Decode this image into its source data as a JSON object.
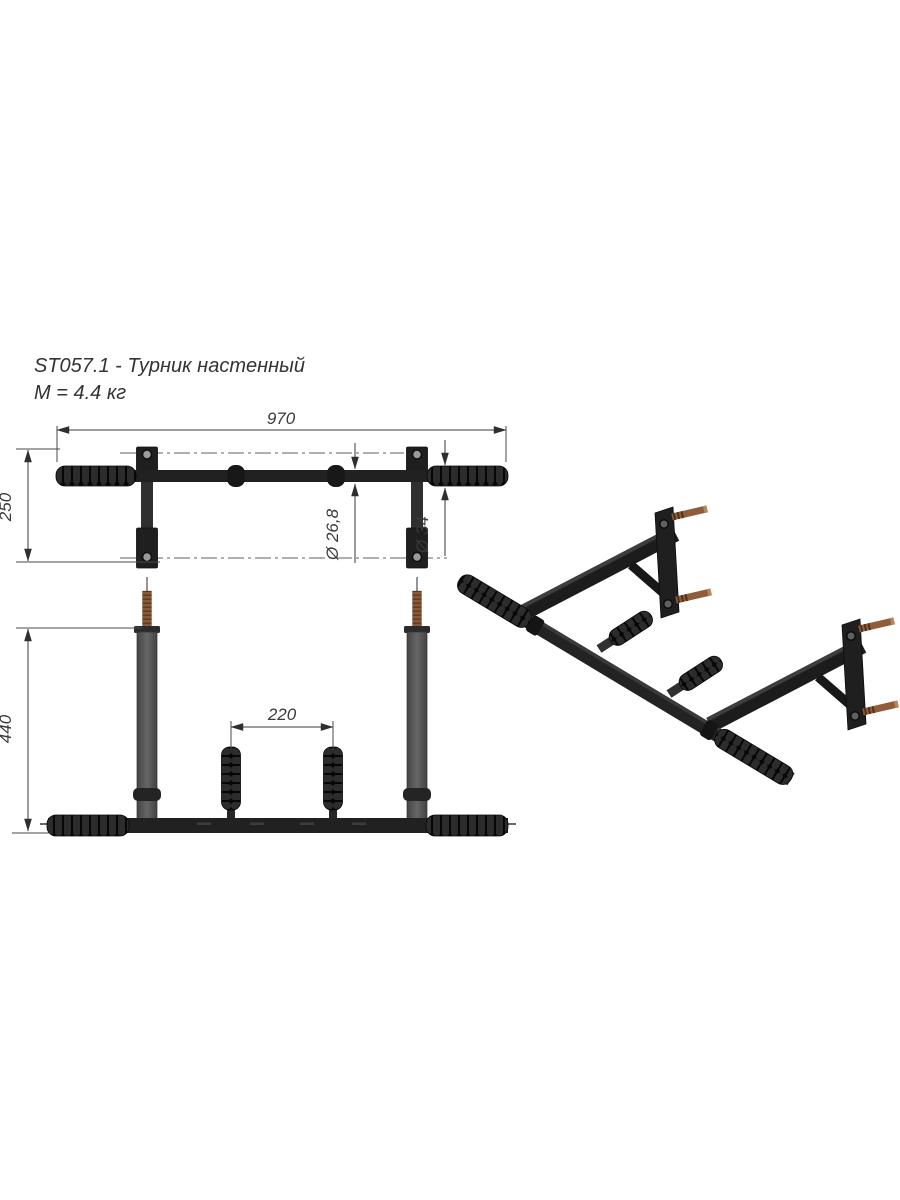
{
  "title": {
    "model_line": "ST057.1 - Турник настенный",
    "mass_line": "М = 4.4 кг"
  },
  "dimensions": {
    "overall_width_mm": "970",
    "plate_height_mm": "250",
    "bar_diameter": "Ø 26,8",
    "grip_diameter": "Ø 34",
    "arm_length_mm": "440",
    "handle_spacing_mm": "220"
  },
  "colors": {
    "background": "#ffffff",
    "metal_dark": "#1f1f1f",
    "grip_rib": "#2c2c2c",
    "arm_gray": "#565656",
    "stud_copper": "#8a5a38",
    "line": "#3a3a3a"
  }
}
